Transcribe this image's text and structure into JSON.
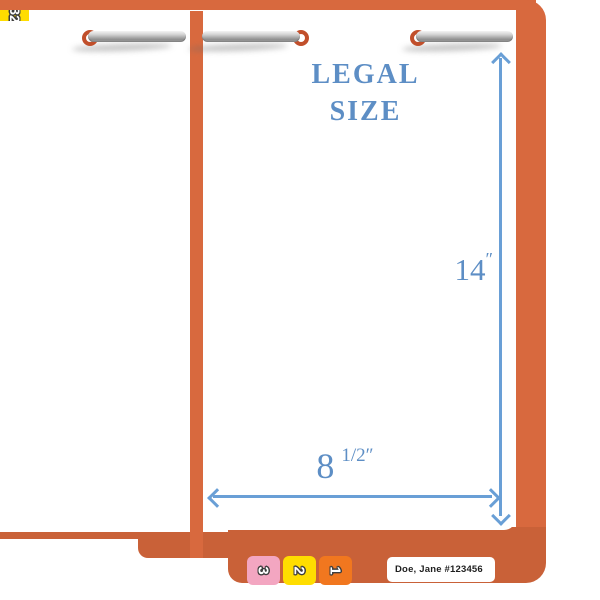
{
  "title": {
    "line1": "LEGAL",
    "line2": "SIZE"
  },
  "dimensions": {
    "height_value": "14",
    "width_value": "8",
    "width_fraction": "1/2",
    "unit_mark": "″"
  },
  "tabs": {
    "digit_tabs": [
      {
        "label": "3",
        "color": "#F3A6C1"
      },
      {
        "label": "2",
        "color": "#FFDD00"
      },
      {
        "label": "1",
        "color": "#F1771F"
      }
    ],
    "name_label": "Doe, Jane #123456",
    "end_tab": {
      "label": "32",
      "color": "#FFDD00"
    }
  },
  "icons": {
    "fasteners": "metal-prong-fastener",
    "height_arrow": "double-arrow-vertical",
    "width_arrow": "double-arrow-horizontal"
  },
  "colors": {
    "folder_orange": "#D8693E",
    "folder_orange_dark": "#C96138",
    "accent_blue": "#5D8EC5",
    "arrow_blue": "#699FD6",
    "grommet_red": "#C14F2B"
  }
}
